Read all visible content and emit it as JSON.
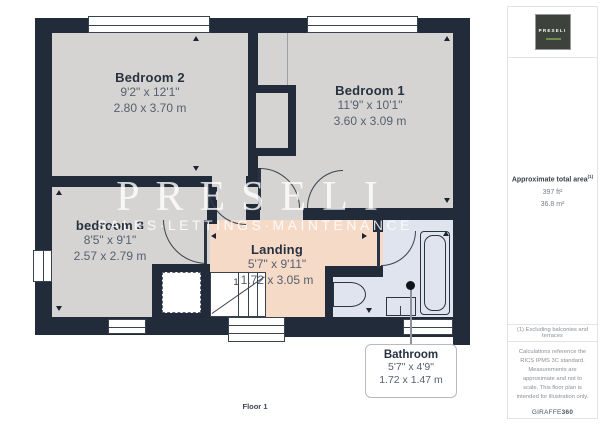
{
  "floor_label": "Floor 1",
  "watermark": {
    "title": "PRESELI",
    "subtitle": "SALES·LETTINGS·MAINTENANCE"
  },
  "rooms": [
    {
      "name": "Bedroom 2",
      "imperial": "9'2\" x 12'1\"",
      "metric": "2.80 x 3.70 m"
    },
    {
      "name": "Bedroom 1",
      "imperial": "11'9\" x 10'1\"",
      "metric": "3.60 x 3.09 m"
    },
    {
      "name": "bedroom 3",
      "imperial": "8'5\" x 9'1\"",
      "metric": "2.57 x 2.79 m"
    },
    {
      "name": "Landing",
      "imperial": "5'7\" x 9'11\"",
      "metric": "1.72 x 3.05 m"
    },
    {
      "name": "Bathroom",
      "imperial": "5'7\" x 4'9\"",
      "metric": "1.72 x 1.47 m"
    }
  ],
  "stairs": {
    "step_label": "1"
  },
  "sidebar": {
    "logo_text": "PRESELI",
    "area_title": "Approximate total area",
    "area_superscript": "(1)",
    "area_ft": "397 ft²",
    "area_m": "36.8 m²",
    "footnote": "(1) Excluding balconies and terraces",
    "disclaimer": "Calculations reference the RICS IPMS 3C standard. Measurements are approximate and not to scale. This floor plan is intended for illustration only.",
    "brand": "GIRAFFE",
    "brand_suffix": "360"
  },
  "colors": {
    "wall": "#212b39",
    "room": "#d5d4d2",
    "landing": "#f5dac8",
    "bathroom": "#dfe4ee",
    "accent_green": "#6f8f4f",
    "label_dark": "#27313f",
    "label_dim": "#566070",
    "panel_border": "#e3e3e3",
    "muted_text": "#8a9097"
  }
}
